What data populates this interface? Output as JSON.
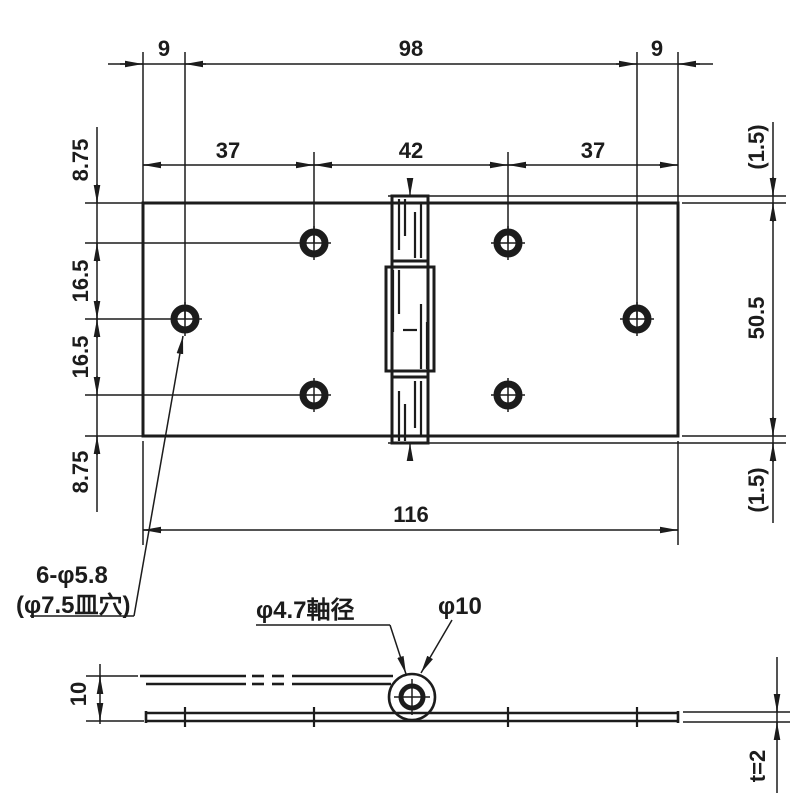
{
  "colors": {
    "background": "#ffffff",
    "ink": "#1c1c1c",
    "plate_fill": "#e7e0d1"
  },
  "plan_view": {
    "dims_top_row": {
      "left": "9",
      "center": "98",
      "right": "9"
    },
    "dims_second_row": {
      "left": "37",
      "center": "42",
      "right": "37"
    },
    "dims_left_column": {
      "top": "8.75",
      "upper_mid": "16.5",
      "lower_mid": "16.5",
      "bottom": "8.75"
    },
    "dims_right_column": {
      "top": "(1.5)",
      "middle": "50.5",
      "bottom": "(1.5)"
    },
    "dim_overall_width": "116",
    "hole_note": {
      "line1": "6-φ5.8",
      "line2": "(φ7.5皿穴)"
    }
  },
  "side_view": {
    "pin_diameter_note": "φ4.7軸径",
    "knuckle_diameter_note": "φ10",
    "dim_overall_height": "10",
    "thickness_note": "t=2"
  }
}
